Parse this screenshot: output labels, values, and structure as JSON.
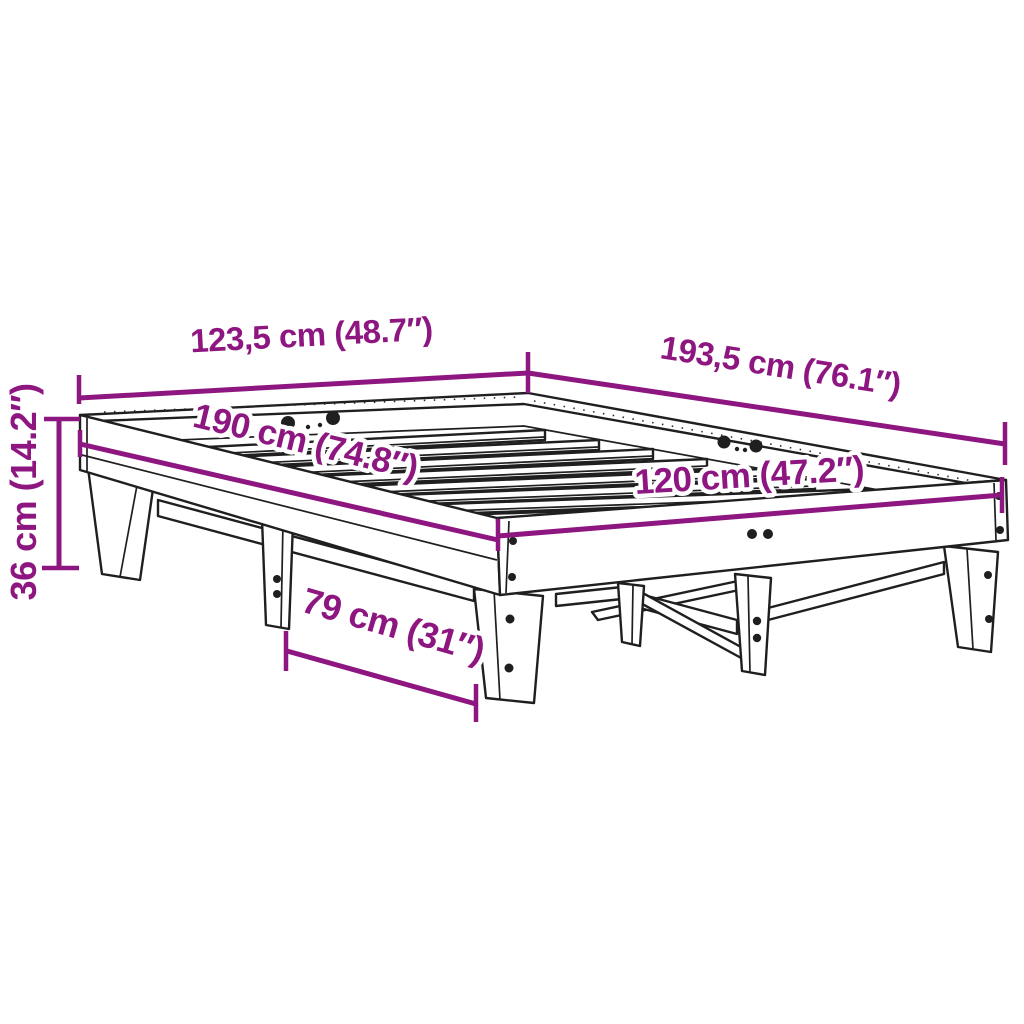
{
  "diagram": {
    "title": "Bed frame dimension diagram",
    "subject": "wooden slatted bed frame, perspective line drawing",
    "style": {
      "accent_color": "#8E1680",
      "line_color": "#1F1F1F",
      "background_color": "#FFFFFF"
    },
    "dimensions": [
      {
        "id": "outer-width",
        "label": "123,5 cm (48.7″)",
        "value_cm": "123,5",
        "value_inch": "48.7"
      },
      {
        "id": "outer-length",
        "label": "193,5 cm (76.1″)",
        "value_cm": "193,5",
        "value_inch": "76.1"
      },
      {
        "id": "inner-length",
        "label": "190 cm (74.8″)",
        "value_cm": "190",
        "value_inch": "74.8"
      },
      {
        "id": "inner-width",
        "label": "120 cm (47.2″)",
        "value_cm": "120",
        "value_inch": "47.2"
      },
      {
        "id": "height",
        "label": "36 cm (14.2″)",
        "value_cm": "36",
        "value_inch": "14.2"
      },
      {
        "id": "leg-span",
        "label": "79 cm (31″)",
        "value_cm": "79",
        "value_inch": "31"
      }
    ]
  }
}
